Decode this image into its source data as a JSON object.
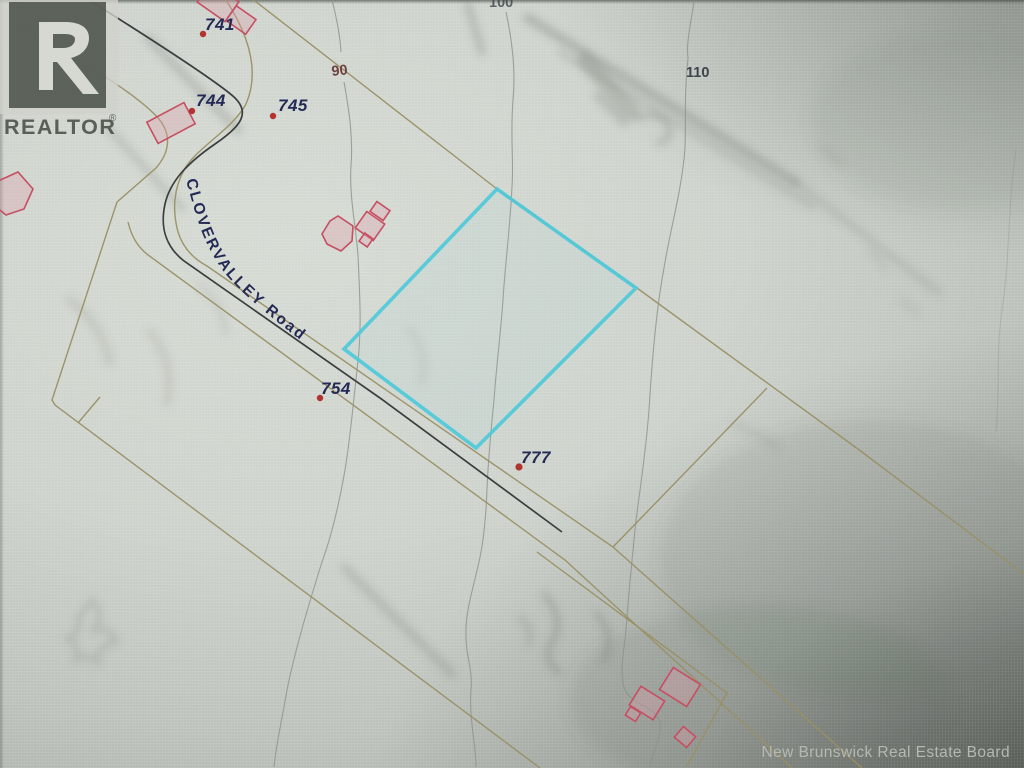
{
  "map": {
    "road_label": "CLOVERVALLEY Road",
    "lots": [
      {
        "label": "741"
      },
      {
        "label": "744"
      },
      {
        "label": "745"
      },
      {
        "label": "754"
      },
      {
        "label": "777"
      }
    ],
    "contour_labels": [
      {
        "value": "90"
      },
      {
        "value": "100"
      },
      {
        "value": "110"
      }
    ]
  },
  "logo": {
    "symbol": "R",
    "wordmark": "REALTOR",
    "registered": "®"
  },
  "attribution": {
    "text": "New Brunswick Real Estate Board"
  },
  "colors": {
    "highlight": "#4fc9da",
    "parcel_line": "#9a9065",
    "road_line": "#3a3e3e",
    "contour_line": "#8d918d",
    "building_stroke": "#c64f62",
    "building_fill": "rgba(225,155,168,0.32)",
    "lot_label": "#242a55",
    "marker_dot": "#b23430",
    "contour_label_90": "#6f4242",
    "contour_label_dark": "#3e444b",
    "logo_box": "#50554e",
    "logo_glyph": "#d6d8d2",
    "wordmark_text": "#454a42",
    "attribution_text": "#b4b9b2"
  }
}
